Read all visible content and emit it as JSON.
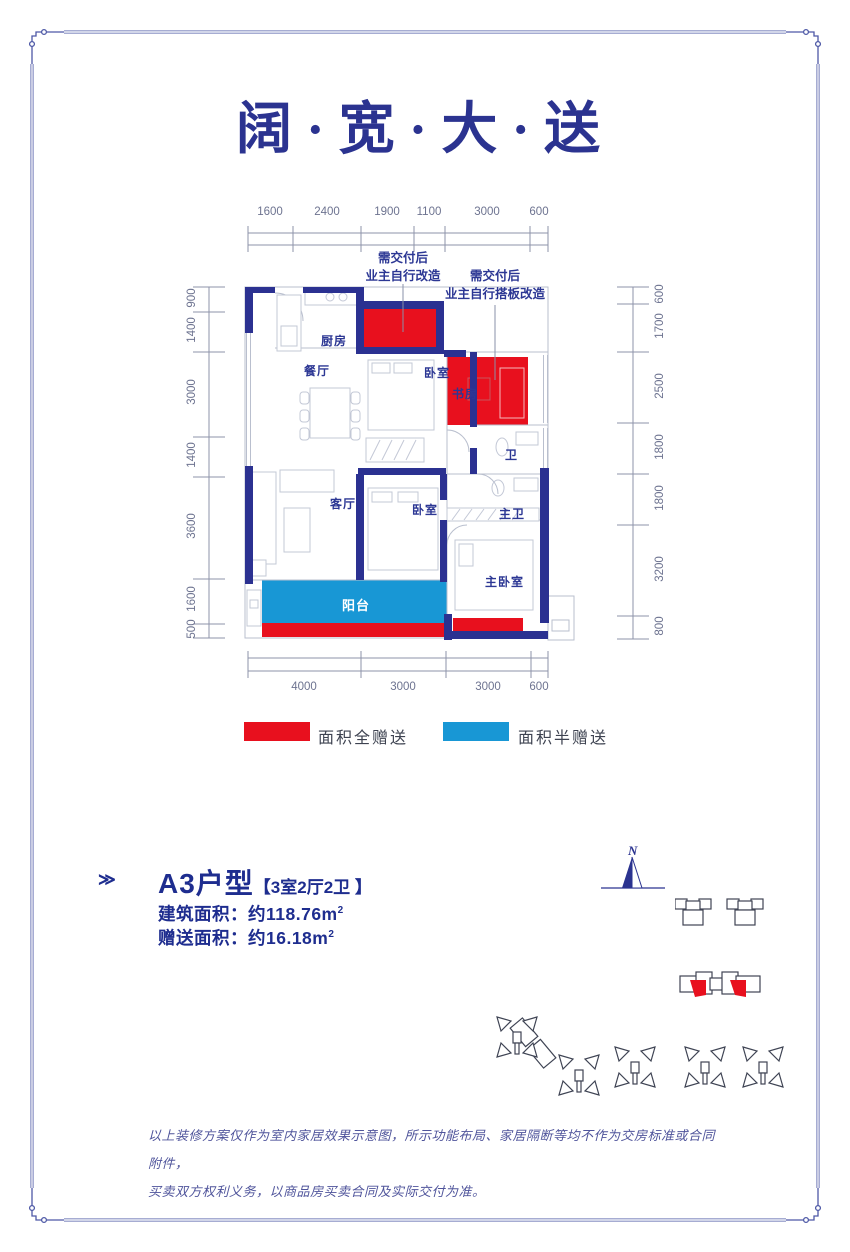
{
  "title": "阔·宽·大·送",
  "floorplan": {
    "dims_top": [
      "1600",
      "2400",
      "1900",
      "1100",
      "3000",
      "600"
    ],
    "dims_bottom": [
      "4000",
      "3000",
      "3000",
      "600"
    ],
    "dims_left": [
      "900",
      "1400",
      "3000",
      "1400",
      "3600",
      "1600",
      "500"
    ],
    "dims_right": [
      "600",
      "1700",
      "2500",
      "1800",
      "1800",
      "3200",
      "800"
    ],
    "annotation1": [
      "需交付后",
      "业主自行改造"
    ],
    "annotation2": [
      "需交付后",
      "业主自行搭板改造"
    ],
    "rooms": {
      "kitchen": "厨房",
      "dining": "餐厅",
      "bedroom_top": "卧室",
      "study": "书房",
      "bath": "卫",
      "living": "客厅",
      "bedroom_mid": "卧室",
      "master_bath": "主卫",
      "master_bedroom": "主卧室",
      "balcony": "阳台"
    }
  },
  "legend": {
    "full": "面积全赠送",
    "half": "面积半赠送"
  },
  "info": {
    "marker": "≫",
    "unit_name": "A3户型",
    "unit_layout": "【3室2厅2卫 】",
    "area_rows": [
      {
        "label": "建筑面积：",
        "value": "约118.76m",
        "sup": "2"
      },
      {
        "label": "赠送面积：",
        "value": "约16.18m",
        "sup": "2"
      }
    ]
  },
  "compass": {
    "label": "N"
  },
  "disclaimer": [
    "以上装修方案仅作为室内家居效果示意图，所示功能布局、家居隔断等均不作为交房标准或合同附件，",
    "买卖双方权利义务，以商品房买卖合同及实际交付为准。"
  ],
  "colors": {
    "red": "#e8101e",
    "blue": "#1897d5",
    "wall": "#2b3191",
    "navy_text": "#1e2d8f",
    "frame": "#4d58a6",
    "dim_text": "#6d7390",
    "line_gray": "#b9bfce"
  }
}
